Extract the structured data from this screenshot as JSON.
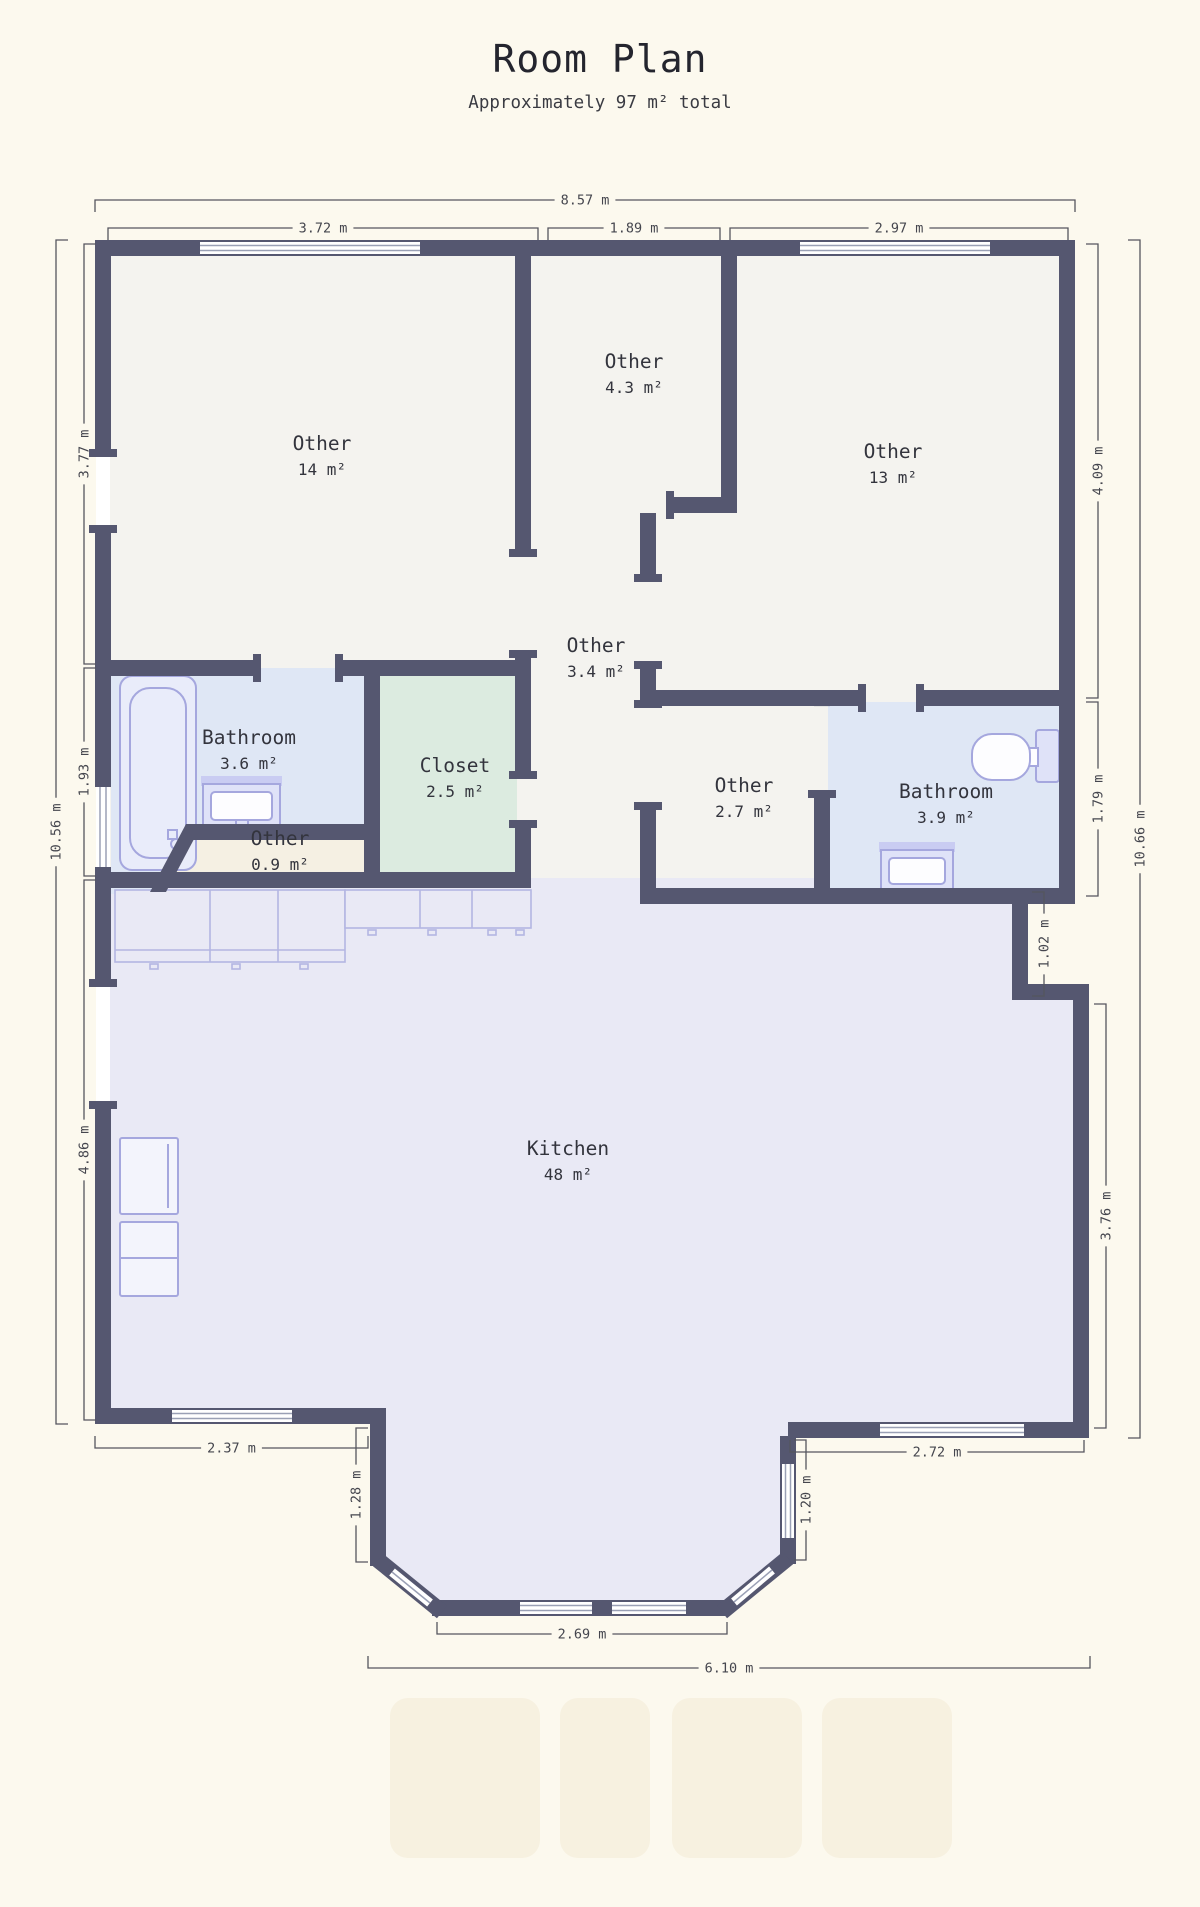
{
  "title": "Room Plan",
  "subtitle": "Approximately 97 m² total",
  "total_area": "97 m²",
  "rooms": [
    {
      "name": "Other",
      "area": "14 m²",
      "x": 322,
      "y": 450
    },
    {
      "name": "Other",
      "area": "4.3 m²",
      "x": 634,
      "y": 368
    },
    {
      "name": "Other",
      "area": "13 m²",
      "x": 893,
      "y": 458
    },
    {
      "name": "Other",
      "area": "3.4 m²",
      "x": 596,
      "y": 652
    },
    {
      "name": "Bathroom",
      "area": "3.6 m²",
      "x": 249,
      "y": 744
    },
    {
      "name": "Closet",
      "area": "2.5 m²",
      "x": 455,
      "y": 772
    },
    {
      "name": "Other",
      "area": "0.9 m²",
      "x": 280,
      "y": 845
    },
    {
      "name": "Other",
      "area": "2.7 m²",
      "x": 744,
      "y": 792
    },
    {
      "name": "Bathroom",
      "area": "3.9 m²",
      "x": 946,
      "y": 798
    },
    {
      "name": "Kitchen",
      "area": "48 m²",
      "x": 568,
      "y": 1155
    }
  ],
  "dimensions": [
    {
      "label": "8.57 m",
      "orient": "h",
      "x1": 95,
      "x2": 1075,
      "y": 200,
      "hook": "down"
    },
    {
      "label": "3.72 m",
      "orient": "h",
      "x1": 108,
      "x2": 538,
      "y": 228,
      "hook": "down"
    },
    {
      "label": "1.89 m",
      "orient": "h",
      "x1": 548,
      "x2": 720,
      "y": 228,
      "hook": "down"
    },
    {
      "label": "2.97 m",
      "orient": "h",
      "x1": 730,
      "x2": 1068,
      "y": 228,
      "hook": "down"
    },
    {
      "label": "3.77 m",
      "orient": "v",
      "y1": 244,
      "y2": 664,
      "x": 84,
      "hook": "right"
    },
    {
      "label": "1.93 m",
      "orient": "v",
      "y1": 668,
      "y2": 876,
      "x": 84,
      "hook": "right"
    },
    {
      "label": "4.86 m",
      "orient": "v",
      "y1": 880,
      "y2": 1420,
      "x": 84,
      "hook": "right"
    },
    {
      "label": "10.56 m",
      "orient": "v",
      "y1": 240,
      "y2": 1424,
      "x": 56,
      "hook": "right"
    },
    {
      "label": "4.09 m",
      "orient": "v",
      "y1": 244,
      "y2": 698,
      "x": 1098,
      "hook": "left"
    },
    {
      "label": "1.79 m",
      "orient": "v",
      "y1": 702,
      "y2": 896,
      "x": 1098,
      "hook": "left"
    },
    {
      "label": "10.66 m",
      "orient": "v",
      "y1": 240,
      "y2": 1438,
      "x": 1140,
      "hook": "left"
    },
    {
      "label": "1.02 m",
      "orient": "v",
      "y1": 892,
      "y2": 996,
      "x": 1044,
      "hook": "left"
    },
    {
      "label": "3.76 m",
      "orient": "v",
      "y1": 1004,
      "y2": 1428,
      "x": 1106,
      "hook": "left"
    },
    {
      "label": "2.37 m",
      "orient": "h",
      "x1": 95,
      "x2": 368,
      "y": 1448,
      "hook": "up"
    },
    {
      "label": "2.72 m",
      "orient": "h",
      "x1": 790,
      "x2": 1084,
      "y": 1452,
      "hook": "up"
    },
    {
      "label": "1.28 m",
      "orient": "v",
      "y1": 1428,
      "y2": 1562,
      "x": 356,
      "hook": "right"
    },
    {
      "label": "1.20 m",
      "orient": "v",
      "y1": 1440,
      "y2": 1560,
      "x": 806,
      "hook": "left"
    },
    {
      "label": "2.69 m",
      "orient": "h",
      "x1": 437,
      "x2": 727,
      "y": 1634,
      "hook": "up"
    },
    {
      "label": "6.10 m",
      "orient": "h",
      "x1": 368,
      "x2": 1090,
      "y": 1668,
      "hook": "up"
    }
  ],
  "colors": {
    "background": "#fcf9ee",
    "wall": "#555770",
    "floor_default": "#f4f3ef",
    "floor_bathroom": "#dfe7f5",
    "floor_closet": "#dcebe0",
    "floor_kitchen": "#e9e9f5",
    "floor_other_small": "#f5f0e3",
    "fixture_stroke": "#a5a7de"
  }
}
